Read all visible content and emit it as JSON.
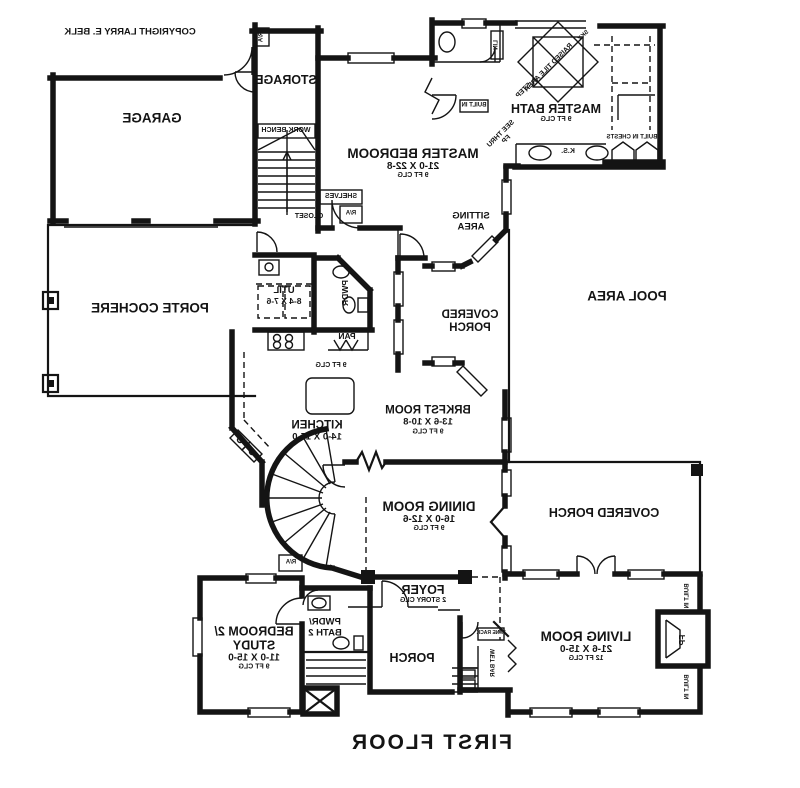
{
  "title": "FIRST FLOOR",
  "copyright": "COPYRIGHT LARRY E. BELK",
  "rooms": {
    "garage": {
      "name": "GARAGE"
    },
    "storage": {
      "name": "STORAGE"
    },
    "porte_cochere": {
      "name": "PORTE COCHERE"
    },
    "master_bedroom": {
      "name": "MASTER BEDROOM",
      "dims": "21-0 X 22-8",
      "clg": "9 FT CLG"
    },
    "master_bath": {
      "name": "MASTER BATH",
      "clg": "9 FT CLG"
    },
    "sitting_area": {
      "line1": "SITTING",
      "line2": "AREA"
    },
    "pool_area": {
      "name": "POOL AREA"
    },
    "covered_porch_side": {
      "line1": "COVERED",
      "line2": "PORCH"
    },
    "covered_porch_rear": {
      "name": "COVERED PORCH"
    },
    "brkfst": {
      "name": "BRKFST ROOM",
      "dims": "13-6 X 10-8",
      "clg": "9 FT CLG"
    },
    "kitchen": {
      "name": "KITCHEN",
      "dims": "14-0 X 15-0",
      "clg": "9 FT CLG"
    },
    "util": {
      "name": "UTIL",
      "dims": "8-4 X 7-6"
    },
    "pwdr": {
      "name": "PWDR"
    },
    "pan": {
      "name": "PAN"
    },
    "dining": {
      "name": "DINING ROOM",
      "dims": "16-0 X 12-6",
      "clg": "9 FT CLG"
    },
    "foyer": {
      "name": "FOYER",
      "clg": "2 STORY CLG"
    },
    "porch": {
      "name": "PORCH"
    },
    "living": {
      "name": "LIVING ROOM",
      "dims": "21-6 X 15-0",
      "clg": "12 FT CLG"
    },
    "bedroom2": {
      "line1": "BEDROOM 2/",
      "line2": "STUDY",
      "dims": "11-0 X 15-0",
      "clg": "9 FT CLG"
    },
    "bath2": {
      "line1": "PWDR/",
      "line2": "BATH 2"
    }
  },
  "fixtures": {
    "work_bench": "WORK BENCH",
    "shelves": "SHELVES",
    "closet": "CLOSET",
    "ra": "R/A",
    "built_in": "BUILT IN",
    "built_in_chests": "BUILT IN CHESTS",
    "ks": "K.S.",
    "lin": "LIN",
    "see_thru": "SEE THRU",
    "fp": "FP",
    "raised_tile": "RAISED TILE AREA",
    "step": "STEP",
    "sky": "SKY",
    "wine_rack": "WINE RACK",
    "wet_bar": "WET BAR"
  },
  "colors": {
    "line": "#141414",
    "bg": "#ffffff"
  }
}
